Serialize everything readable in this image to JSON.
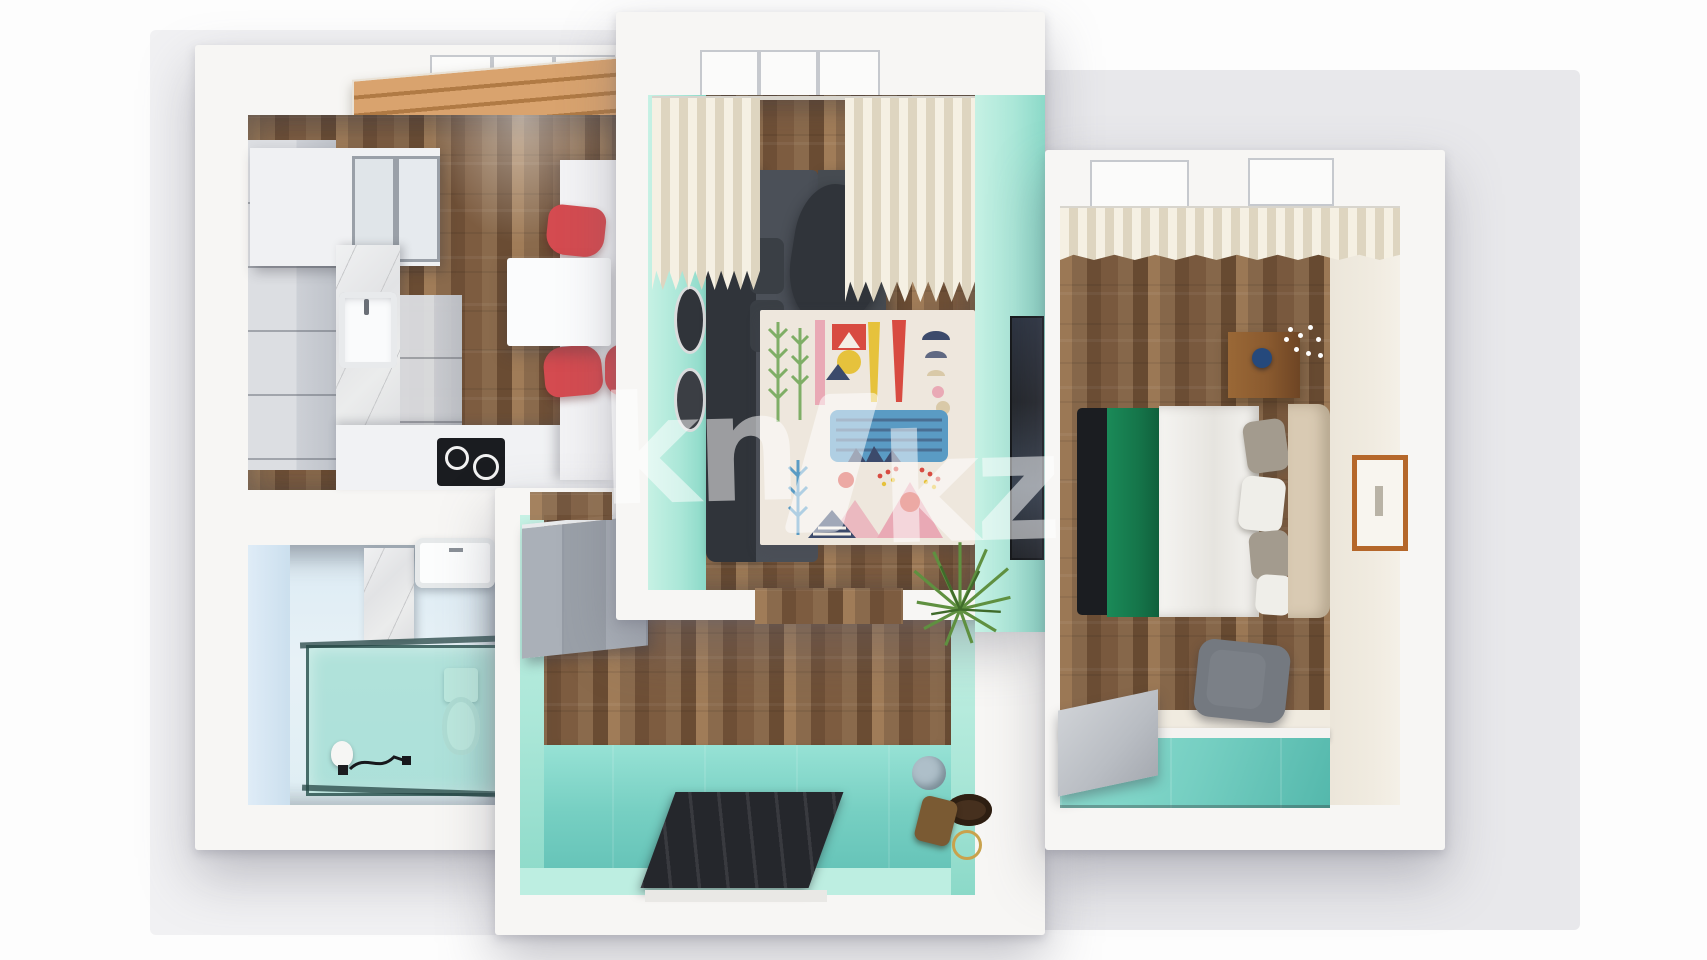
{
  "watermark": {
    "left": "kn",
    "right": "kz"
  },
  "palette": {
    "page_bg": "#fdfdfd",
    "backdrop": "#e8e8eb",
    "backdrop_soft": "#f1f1f3",
    "wall": "#f7f6f4",
    "wall_shade": "#e3e2e0",
    "wood": "#8a6a4c",
    "wood_dark": "#6e4f36",
    "wood_light": "#a07c58",
    "wood_mid": "#7d5c40",
    "wood_deep": "#6a4c33",
    "mint": "#abe7d8",
    "mint_light": "#c6f1e4",
    "mint_deep": "#8bd9c8",
    "teal_floor": "#76cfc2",
    "teal_light": "#97e2d5",
    "teal_deep": "#5fbfb4",
    "bath_blue": "#cbdfee",
    "bath_blue_light": "#dfecf7",
    "bath_floor": "#e7f1f6",
    "cabinet_gray": "#cdd0d6",
    "cabinet_dark": "#bfc3ca",
    "counter_white": "#f1f2f4",
    "cooktop": "#1a1c20",
    "marble": "#ebecec",
    "marble_vein": "#c9cacc",
    "table_white": "#fbfcfd",
    "chair_red": "#d44b50",
    "sofa": "#4b5058",
    "sofa_dark": "#30343a",
    "cushion_dark": "#3a3f45",
    "rug_bg": "#eee7dd",
    "curtain": "#f5f0e3",
    "curtain_shade": "#ded5c0",
    "bed_white": "#f5f4f1",
    "blanket_green": "#15754a",
    "blanket_black": "#1b1d21",
    "pillow_gray": "#a39b8e",
    "pillow_white": "#efeee9",
    "headboard": "#d9cab3",
    "nightstand": "#8a5a2f",
    "vase_blue": "#25497c",
    "frame_orange": "#b5672a",
    "desk_gray": "#b9bdc3",
    "chair_gray": "#7b8087",
    "plant_green": "#5f9040",
    "plant_dark": "#3f6b2a",
    "mat_dark": "#25272c",
    "glass_teal": "rgba(118,209,189,0.48)",
    "glass_frame": "rgba(38,70,68,0.75)",
    "tv_dark": "#23262b",
    "hat_brown": "#46301e",
    "bag_brown": "#7a5a33",
    "cap_gray": "#aebfc9",
    "ring_gold": "#c9a24c",
    "blind_tan": "#d9a36e",
    "blind_fold": "#b07a44",
    "cream_wall": "#f0ebe0",
    "art_green": "#7fae66",
    "art_red": "#d84b41",
    "art_yellow": "#e6c23c",
    "art_pink": "#e9a9b5",
    "art_navy": "#3c4a6b",
    "art_blue": "#5a9bc4",
    "art_beige": "#d9c9a8",
    "watermark_white": "rgba(255,255,255,0.52)"
  }
}
